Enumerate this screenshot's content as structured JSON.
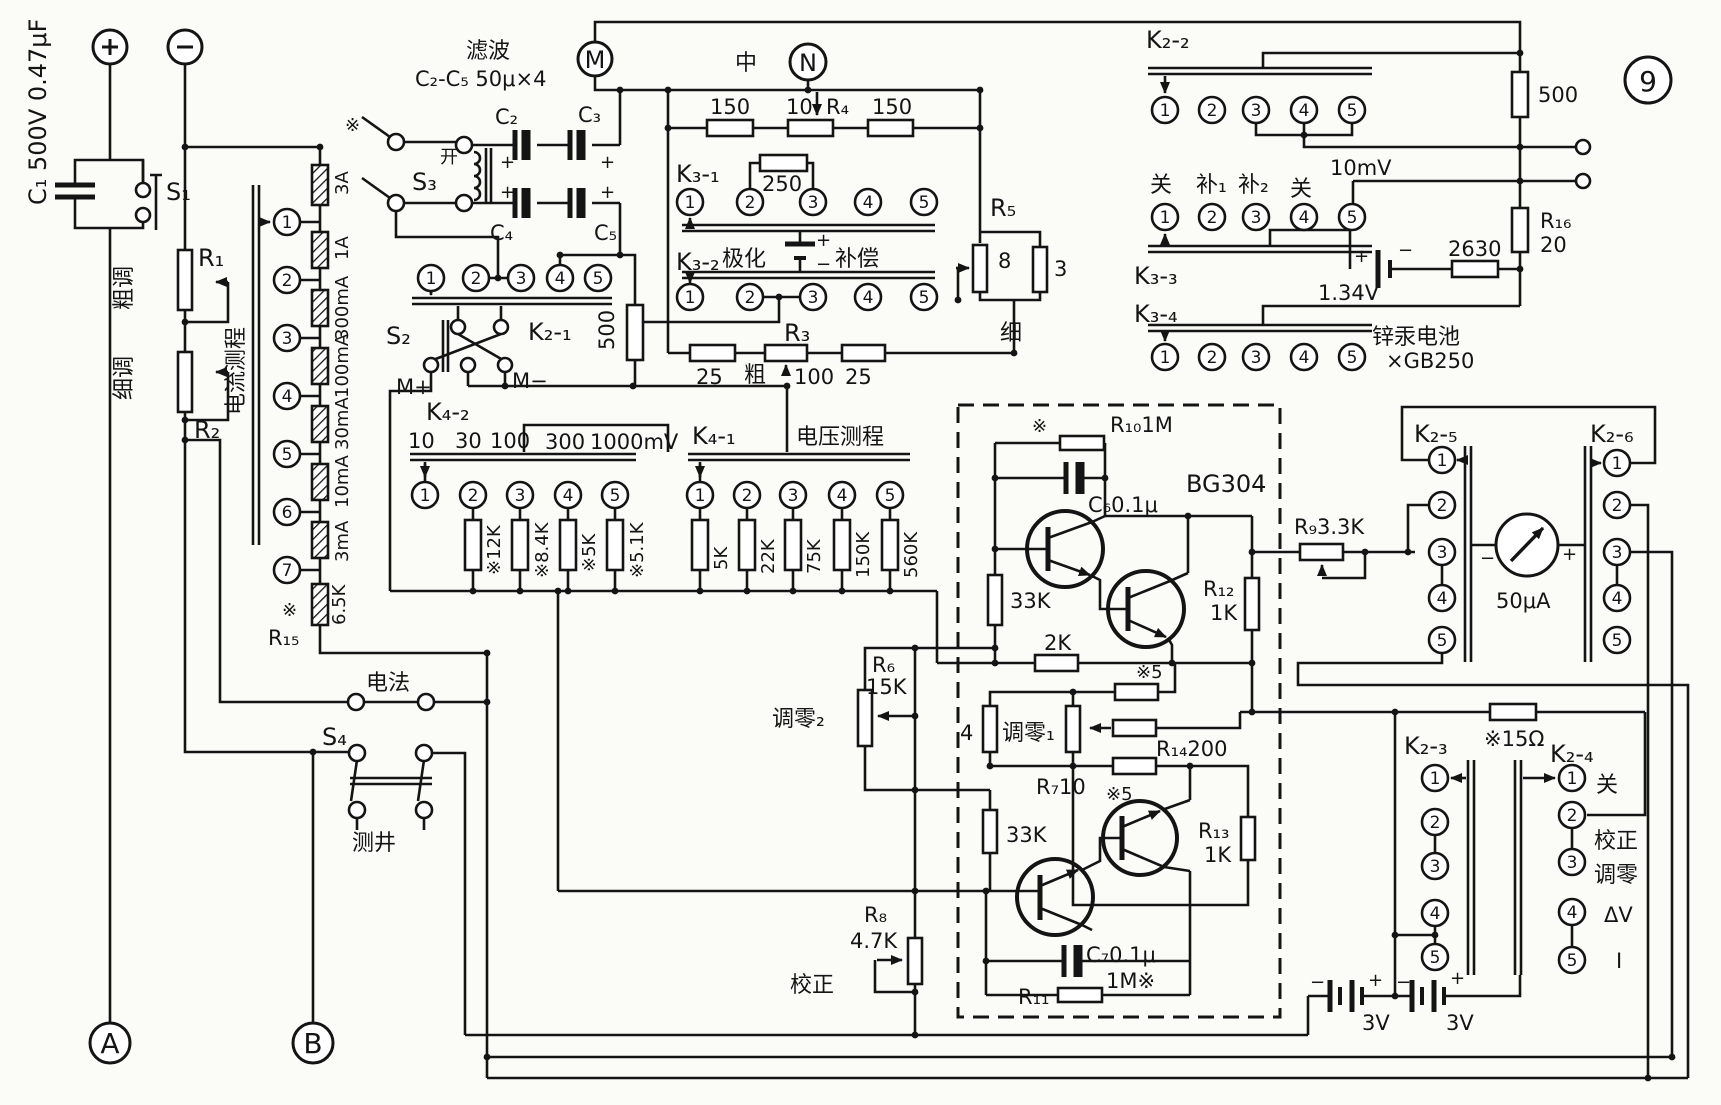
{
  "title": "电位差计测量仪电路原理图 (图9)",
  "figure_number": "9",
  "digits": {
    "d1": "1",
    "d2": "2",
    "d3": "3",
    "d4": "4",
    "d5": "5",
    "d6": "6",
    "d7": "7"
  },
  "t": {
    "plus": "+",
    "minus": "−",
    "star": "※",
    "m": "M",
    "n": "N",
    "a": "A",
    "b": "B",
    "fig9": "9",
    "c1": "C₁ 500V 0.47μF",
    "s1": "S₁",
    "r1": "R₁",
    "r2": "R₂",
    "cutiao": "粗调",
    "xitiao": "细调",
    "dianliu": "电流测程",
    "r3a": "3A",
    "r1a": "1A",
    "r300ma": "300mA",
    "r100ma": "100mA",
    "r30ma": "30mA",
    "r10ma": "10mA",
    "r3ma": "3mA",
    "r65k": "6.5K",
    "r15": "R₁₅",
    "dianfa": "电法",
    "s4": "S₄",
    "cejing": "测井",
    "lvbo": "滤波",
    "c2c5": "C₂-C₅ 50μ×4",
    "s3": "S₃",
    "kai": "开",
    "c2": "C₂",
    "c3": "C₃",
    "c4": "C₄",
    "c5": "C₅",
    "s2": "S₂",
    "k21": "K₂-₁",
    "mplus": "M+",
    "mminus": "M−",
    "v500": "500",
    "k42": "K₄-₂",
    "v10": "10",
    "v30": "30",
    "v100": "100",
    "v300": "300",
    "v1000mv": "1000mV",
    "r12k": "※12K",
    "r84k": "※8.4K",
    "r5ks": "※5K",
    "r51k": "※5.1K",
    "k41": "K₄-₁",
    "dianya": "电压测程",
    "v5k": "5K",
    "v22k": "22K",
    "v75k": "75K",
    "v150k": "150K",
    "v560k": "560K",
    "zhong": "中",
    "v150": "150",
    "r4": "R₄",
    "k31": "K₃-₁",
    "v250": "250",
    "k32": "K₃-₂",
    "jihua": "极化",
    "buchang": "补偿",
    "r3": "R₃",
    "v25": "25",
    "cu": "粗",
    "xi": "细",
    "r5": "R₅",
    "v8": "8",
    "v3": "3",
    "k22": "K₂-₂",
    "guan": "关",
    "bu1": "补₁",
    "bu2": "补₂",
    "mv10": "10mV",
    "k33": "K₃-₃",
    "v134": "1.34V",
    "k34": "K₃-₄",
    "xinhong": "锌汞电池",
    "gb250": "×GB250",
    "r16": "R₁₆",
    "v20": "20",
    "v2630": "2630",
    "bg304": "BG304",
    "r10": "R₁₀1M",
    "c6": "C₆0.1μ",
    "v33k": "33K",
    "v2k": "2K",
    "r6": "R₆",
    "v15k": "15K",
    "tiaoling2": "调零₂",
    "v4": "4",
    "tiaoling1": "调零₁",
    "star5": "※5",
    "r14": "R₁₄200",
    "r7": "R₇10",
    "r12": "R₁₂",
    "v1k": "1K",
    "r13": "R₁₃",
    "c7": "C₇0.1μ",
    "r11": "R₁₁",
    "v1m": "1M※",
    "r8": "R₈",
    "v47k": "4.7K",
    "jiaozheng": "校正",
    "r9": "R₉3.3K",
    "k25": "K₂-₅",
    "k26": "K₂-₆",
    "ua50": "50μA",
    "star15": "※15Ω",
    "k23": "K₂-₃",
    "k24": "K₂-₄",
    "tiaoling": "调零",
    "dv": "ΔV",
    "ii": "I",
    "v3v": "3V"
  }
}
